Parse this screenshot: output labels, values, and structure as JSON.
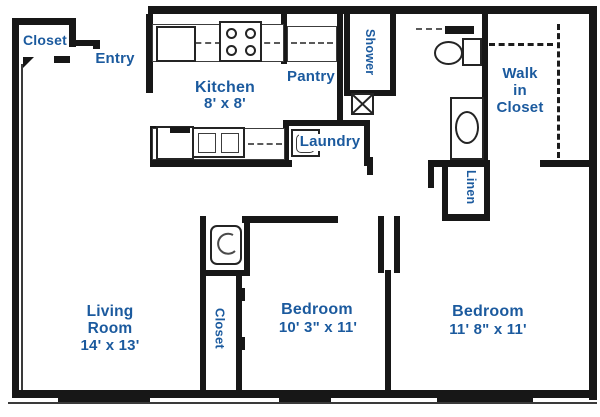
{
  "colors": {
    "label_text": "#1b5a9e",
    "wall": "#171717"
  },
  "rooms": {
    "entry_closet": {
      "label": "Closet"
    },
    "entry": {
      "label": "Entry"
    },
    "kitchen": {
      "name": "Kitchen",
      "dims": "8' x 8'"
    },
    "pantry": {
      "label": "Pantry"
    },
    "shower": {
      "label": "Shower"
    },
    "walk_in_closet": {
      "label": "Walk in Closet"
    },
    "laundry": {
      "label": "Laundry"
    },
    "linen": {
      "label": "Linen"
    },
    "living_room": {
      "name": "Living Room",
      "dims": "14' x 13'"
    },
    "bedroom_1_closet": {
      "label": "Closet"
    },
    "bedroom_1": {
      "name": "Bedroom",
      "dims": "10' 3\" x 11'"
    },
    "bedroom_2": {
      "name": "Bedroom",
      "dims": "11' 8\" x 11'"
    }
  },
  "fixtures": {
    "kitchen": [
      "refrigerator",
      "stove",
      "double-sink",
      "dishwasher",
      "counters"
    ],
    "pantry": [
      "shelves"
    ],
    "laundry": [
      "washer"
    ],
    "bathroom": [
      "toilet",
      "vanity-sink",
      "mirror"
    ],
    "shower": [
      "shower-stall"
    ],
    "utility": [
      "water-heater",
      "vent-chase"
    ],
    "walk_in_closet": [
      "hanging-rods"
    ],
    "windows": 3
  }
}
